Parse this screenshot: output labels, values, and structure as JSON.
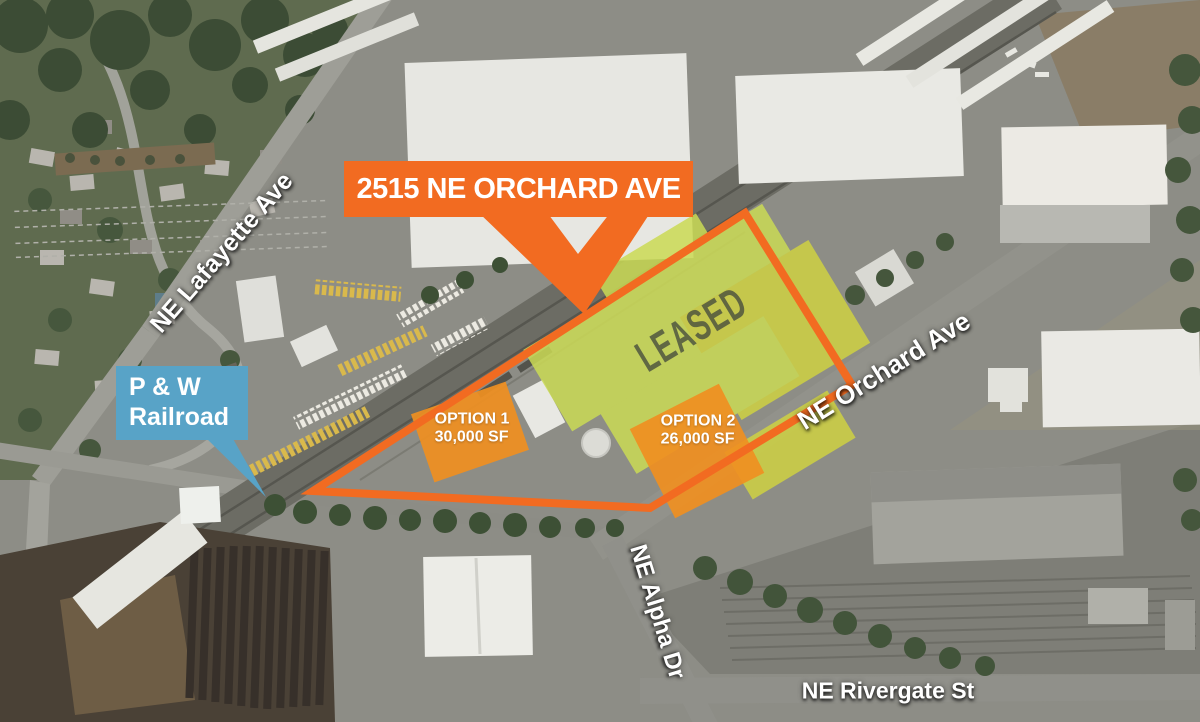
{
  "title_callout": {
    "label": "2515 NE ORCHARD AVE"
  },
  "railroad_callout": {
    "line1": "P & W",
    "line2": "Railroad"
  },
  "leased_overlay": {
    "label": "LEASED"
  },
  "option1": {
    "name": "OPTION 1",
    "size": "30,000 SF"
  },
  "option2": {
    "name": "OPTION 2",
    "size": "26,000 SF"
  },
  "streets": {
    "lafayette": "NE Lafayette Ave",
    "orchard": "NE Orchard Ave",
    "alpha": "NE Alpha Dr",
    "rivergate": "NE Rivergate St"
  },
  "colors": {
    "accent_orange": "#f26b21",
    "option_orange": "#f09021",
    "leased_green": "#cbdb55",
    "leased_green_dark": "#cfd243",
    "railroad_blue": "#58a3c7",
    "leased_text_gray": "#4b503e"
  }
}
